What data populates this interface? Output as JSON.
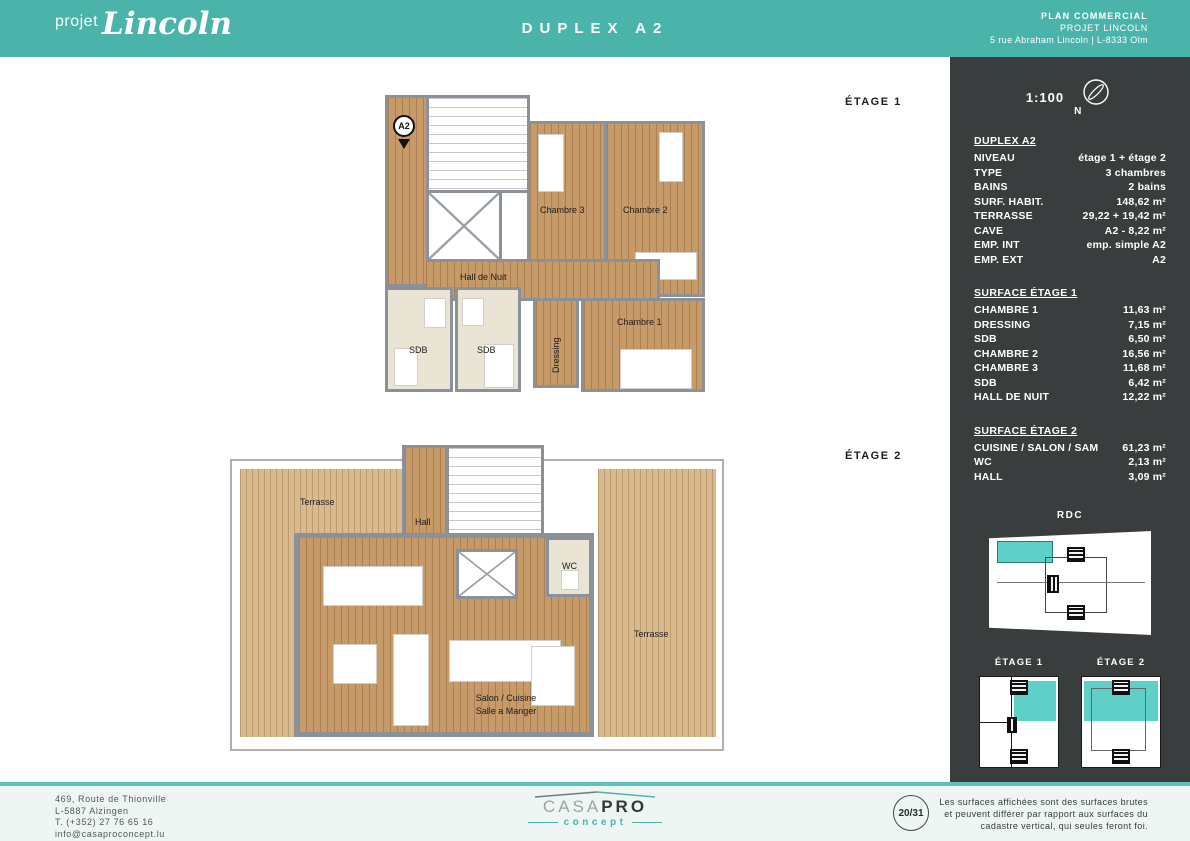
{
  "header": {
    "logo_prefix": "projet",
    "logo_name": "Lincoln",
    "title": "DUPLEX A2",
    "doc_type": "PLAN COMMERCIAL",
    "project": "PROJET LINCOLN",
    "address": "5 rue Abraham Lincoln | L-8333 Olm"
  },
  "panel": {
    "scale": "1:100",
    "compass_label": "N",
    "unit_title": "DUPLEX A2",
    "specs": [
      {
        "label": "NIVEAU",
        "value": "étage 1 + étage 2"
      },
      {
        "label": "TYPE",
        "value": "3 chambres"
      },
      {
        "label": "BAINS",
        "value": "2 bains"
      },
      {
        "label": "SURF. HABIT.",
        "value": "148,62 m²"
      },
      {
        "label": "TERRASSE",
        "value": "29,22 + 19,42 m²"
      },
      {
        "label": "CAVE",
        "value": "A2 - 8,22 m²"
      },
      {
        "label": "EMP. INT",
        "value": "emp. simple A2"
      },
      {
        "label": "EMP. EXT",
        "value": "A2"
      }
    ],
    "surface_etage1": {
      "title": "SURFACE ÉTAGE 1",
      "rows": [
        {
          "label": "CHAMBRE 1",
          "value": "11,63 m²"
        },
        {
          "label": "DRESSING",
          "value": "7,15 m²"
        },
        {
          "label": "SDB",
          "value": "6,50 m²"
        },
        {
          "label": "CHAMBRE 2",
          "value": "16,56 m²"
        },
        {
          "label": "CHAMBRE 3",
          "value": "11,68 m²"
        },
        {
          "label": "SDB",
          "value": "6,42 m²"
        },
        {
          "label": "HALL DE NUIT",
          "value": "12,22 m²"
        }
      ]
    },
    "surface_etage2": {
      "title": "SURFACE ÉTAGE 2",
      "rows": [
        {
          "label": "CUISINE / SALON / SAM",
          "value": "61,23 m²"
        },
        {
          "label": "WC",
          "value": "2,13 m²"
        },
        {
          "label": "HALL",
          "value": "3,09 m²"
        }
      ]
    },
    "thumbs": {
      "rdc_label": "RDC",
      "etage1_label": "ÉTAGE 1",
      "etage2_label": "ÉTAGE 2"
    }
  },
  "plans": {
    "etage1": {
      "label": "ÉTAGE 1",
      "marker": "A2",
      "rooms": {
        "chambre3": "Chambre 3",
        "chambre2": "Chambre 2",
        "hall": "Hall de Nuit",
        "chambre1": "Chambre 1",
        "sdb1": "SDB",
        "sdb2": "SDB",
        "dressing": "Dressing"
      }
    },
    "etage2": {
      "label": "ÉTAGE 2",
      "terrasse_tl": "Terrasse",
      "hall": "Hall",
      "wc": "WC",
      "terrasse_r": "Terrasse",
      "salon_line1": "Salon / Cuisine",
      "salon_line2": "Salle a Manger"
    }
  },
  "footer": {
    "address_lines": [
      "469, Route de Thionville",
      "L-5887 Alzingen",
      "T. (+352) 27 76 65 16",
      "info@casaproconcept.lu"
    ],
    "brand_casa": "CASA",
    "brand_pro": "PRO",
    "brand_concept": "concept",
    "page": "20/31",
    "disclaimer_lines": [
      "Les surfaces affichées sont des surfaces brutes",
      "et peuvent différer par rapport aux surfaces du",
      "cadastre vertical, qui seules feront foi."
    ]
  },
  "colors": {
    "teal_header": "#4ab4ab",
    "teal_light": "#5fd0c8",
    "panel_dark": "#3a3d3d",
    "wood_floor": "#c79a69",
    "terrace_deck": "#d9ba8e",
    "wall_gray": "#8b9199"
  }
}
